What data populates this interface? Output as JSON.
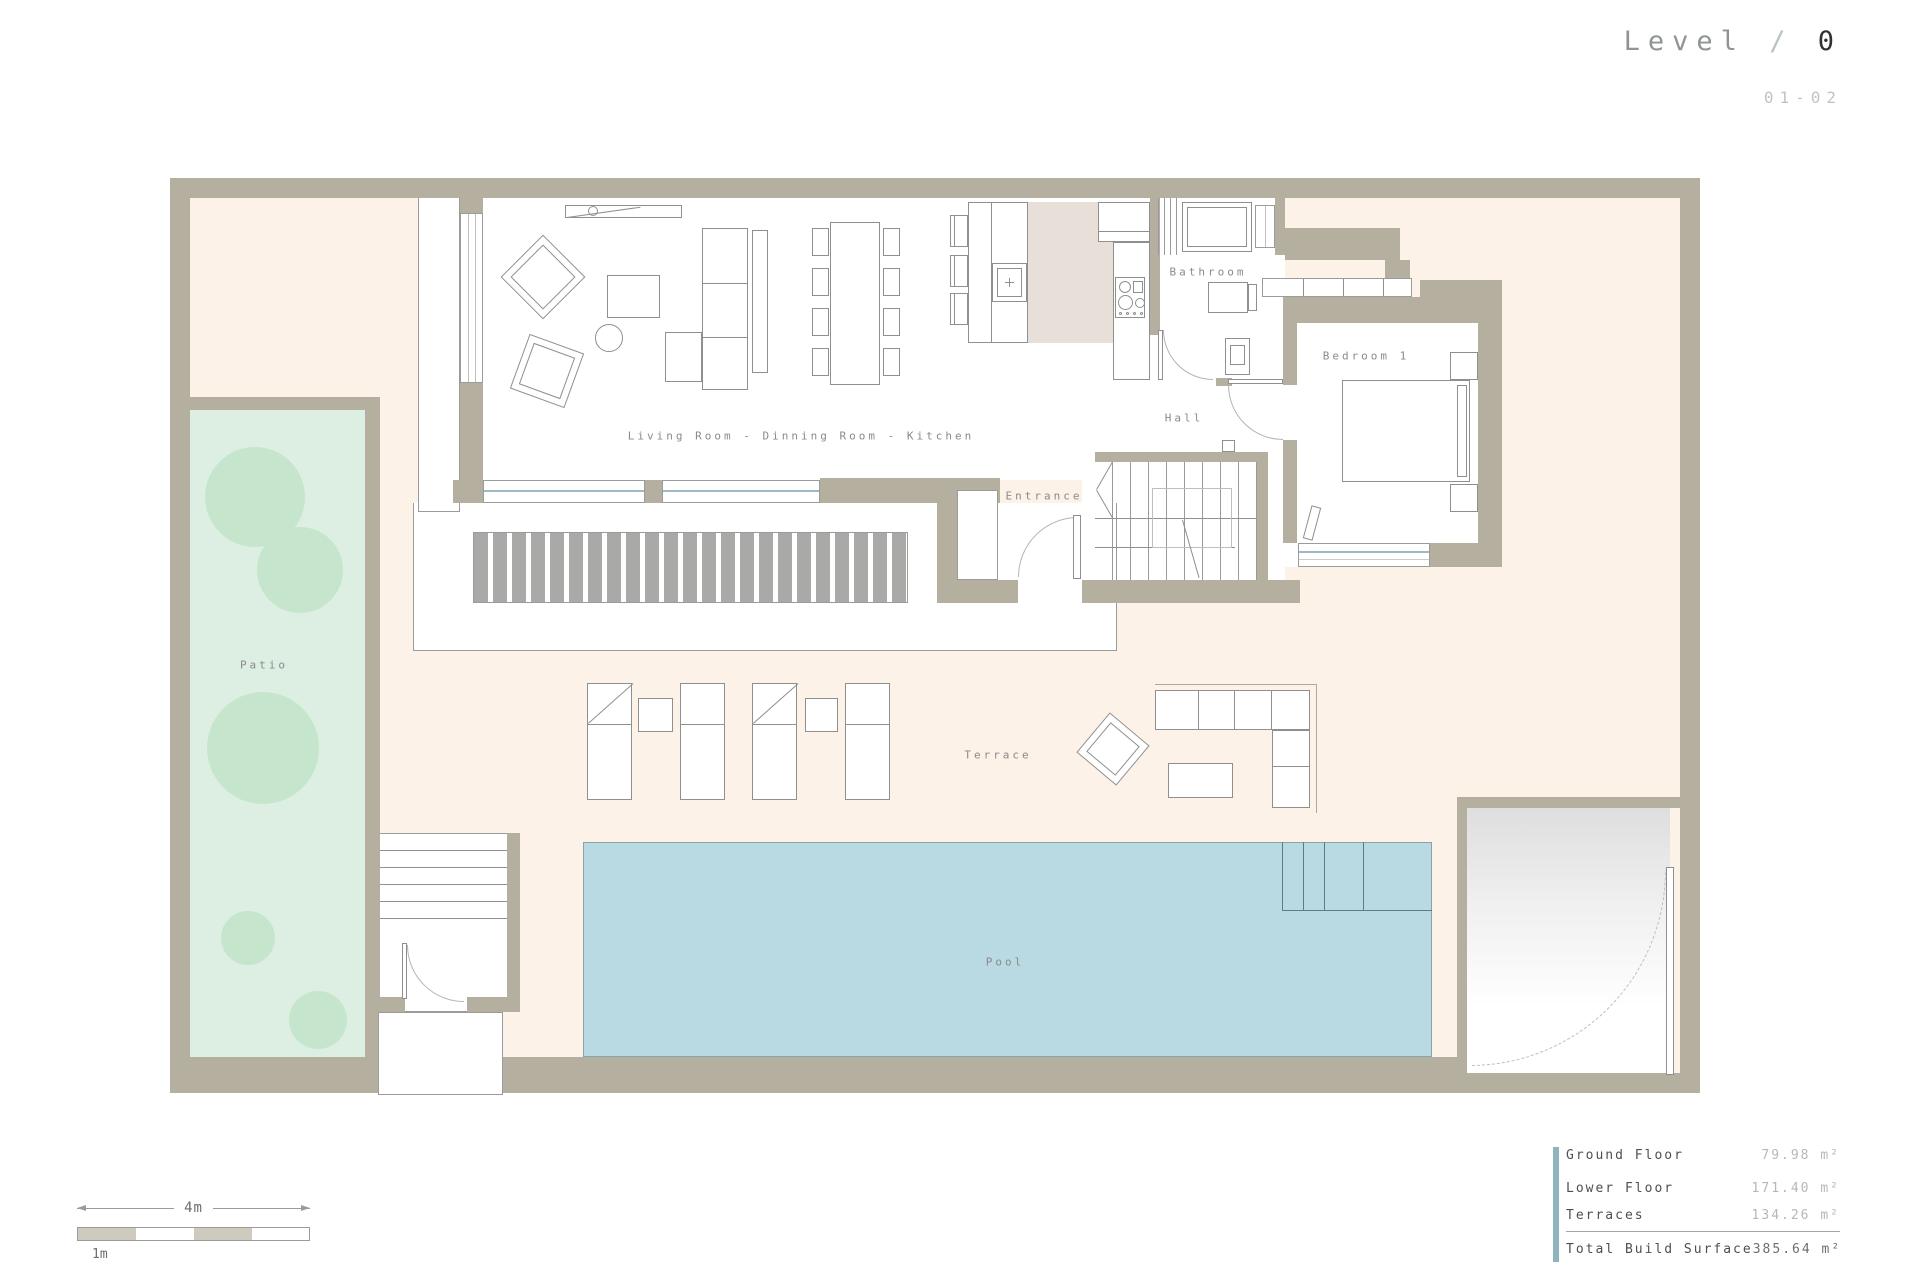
{
  "title": {
    "level_label": "Level",
    "separator": "/",
    "level_number": "0",
    "sheet": "01-02"
  },
  "rooms": {
    "living": "Living Room - Dinning Room - Kitchen",
    "entrance": "Entrance",
    "hall": "Hall",
    "bathroom": "Bathroom",
    "bedroom": "Bedroom 1",
    "patio": "Patio",
    "terrace": "Terrace",
    "pool": "Pool"
  },
  "scale_bar": {
    "total_label": "4m",
    "unit_label": "1m"
  },
  "areas": {
    "rows": [
      {
        "label": "Ground Floor",
        "value": "79.98 m²"
      },
      {
        "label": "Lower Floor",
        "value": "171.40 m²"
      },
      {
        "label": "Terraces",
        "value": "134.26 m²"
      }
    ],
    "total": {
      "label": "Total Build Surface",
      "value": "385.64 m²"
    }
  },
  "colors": {
    "wall": "#b5afa0",
    "site_fill": "#fdf2e8",
    "patio_fill": "#dcefe2",
    "tree_fill": "#c5e6cc",
    "pool_fill": "#b9d9e3",
    "kitchen_floor": "#e9dfd9",
    "deck_slat": "#a9a9a7",
    "accent_bar": "#8fb4bd",
    "title_number": "#2e3234",
    "label_gray": "#8a8a8a"
  }
}
